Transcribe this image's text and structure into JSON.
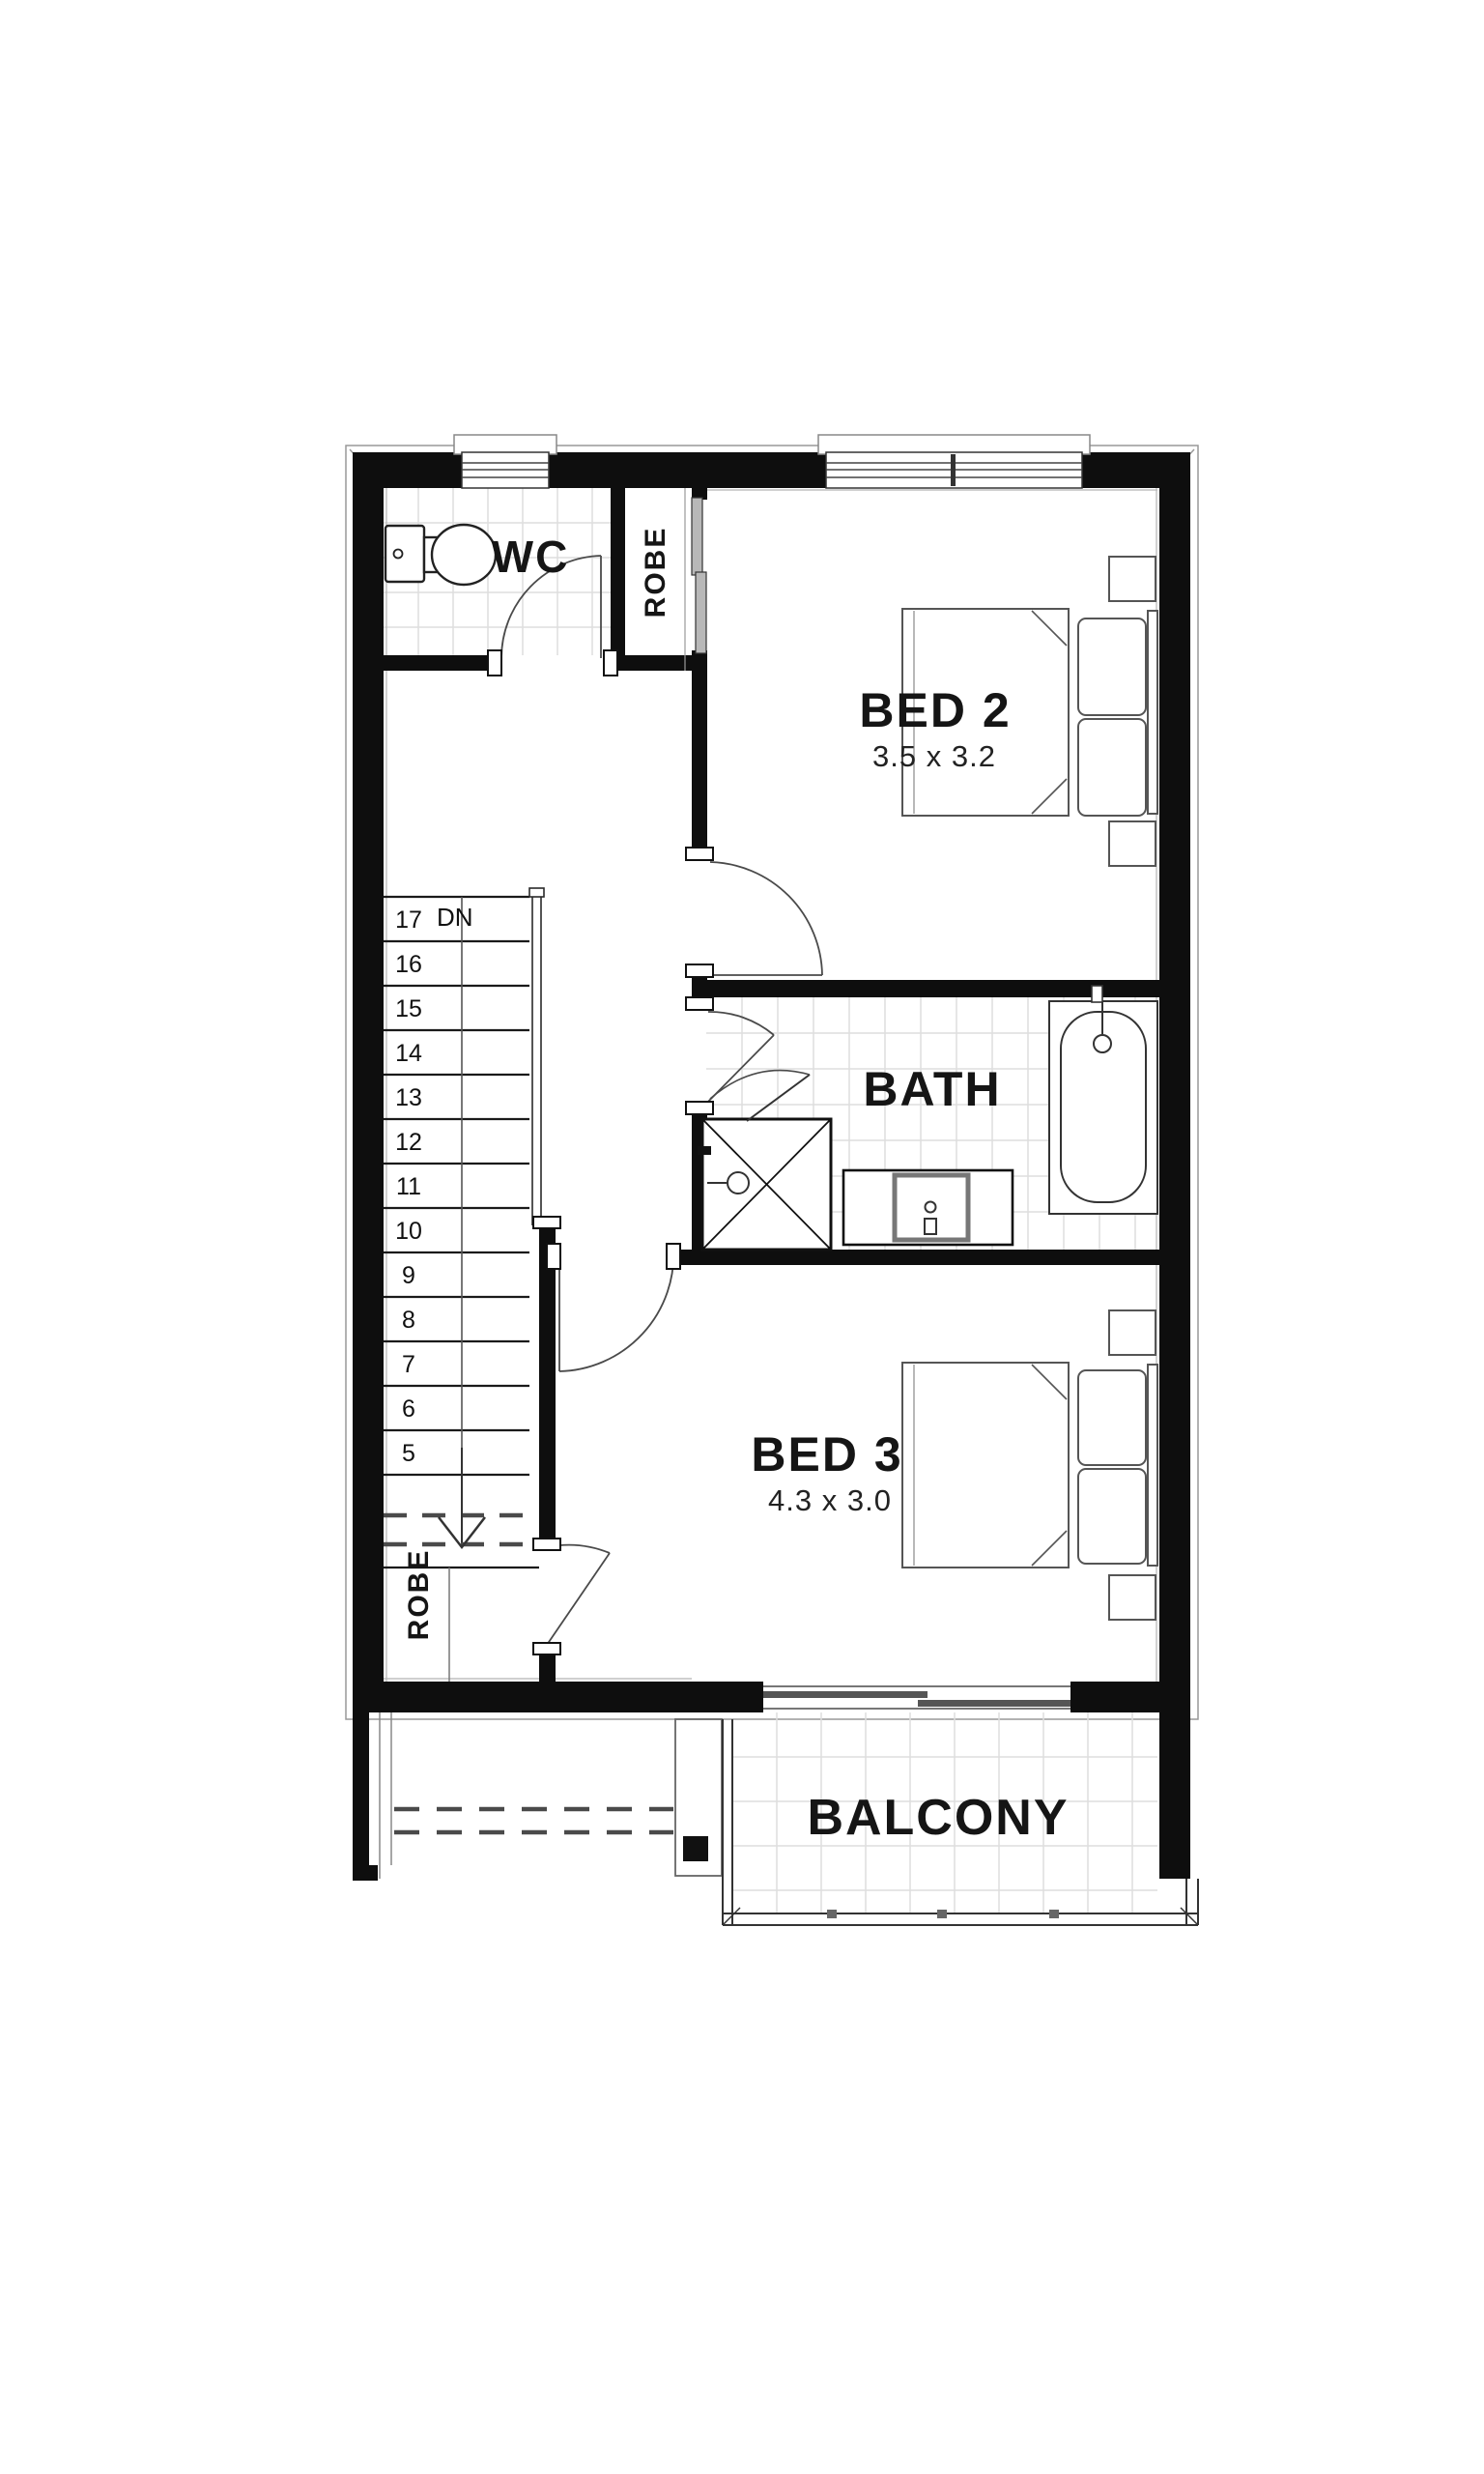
{
  "floor_plan": {
    "rooms": {
      "wc": {
        "label": "WC"
      },
      "robe_upper": {
        "label": "ROBE"
      },
      "bed2": {
        "label": "BED 2",
        "dimensions": "3.5 x 3.2"
      },
      "bath": {
        "label": "BATH"
      },
      "bed3": {
        "label": "BED 3",
        "dimensions": "4.3 x 3.0"
      },
      "robe_lower": {
        "label": "ROBE"
      },
      "balcony": {
        "label": "BALCONY"
      }
    },
    "stairs": {
      "down_label": "DN",
      "steps": [
        "17",
        "16",
        "15",
        "14",
        "13",
        "12",
        "11",
        "10",
        "9",
        "8",
        "7",
        "6",
        "5"
      ]
    },
    "colors": {
      "wall": "#0e0e0e",
      "tile_grid": "#dedede",
      "fixture_line": "#3a3a3a",
      "door_line": "#4a4a4a",
      "text": "#151515",
      "background": "#ffffff"
    }
  }
}
